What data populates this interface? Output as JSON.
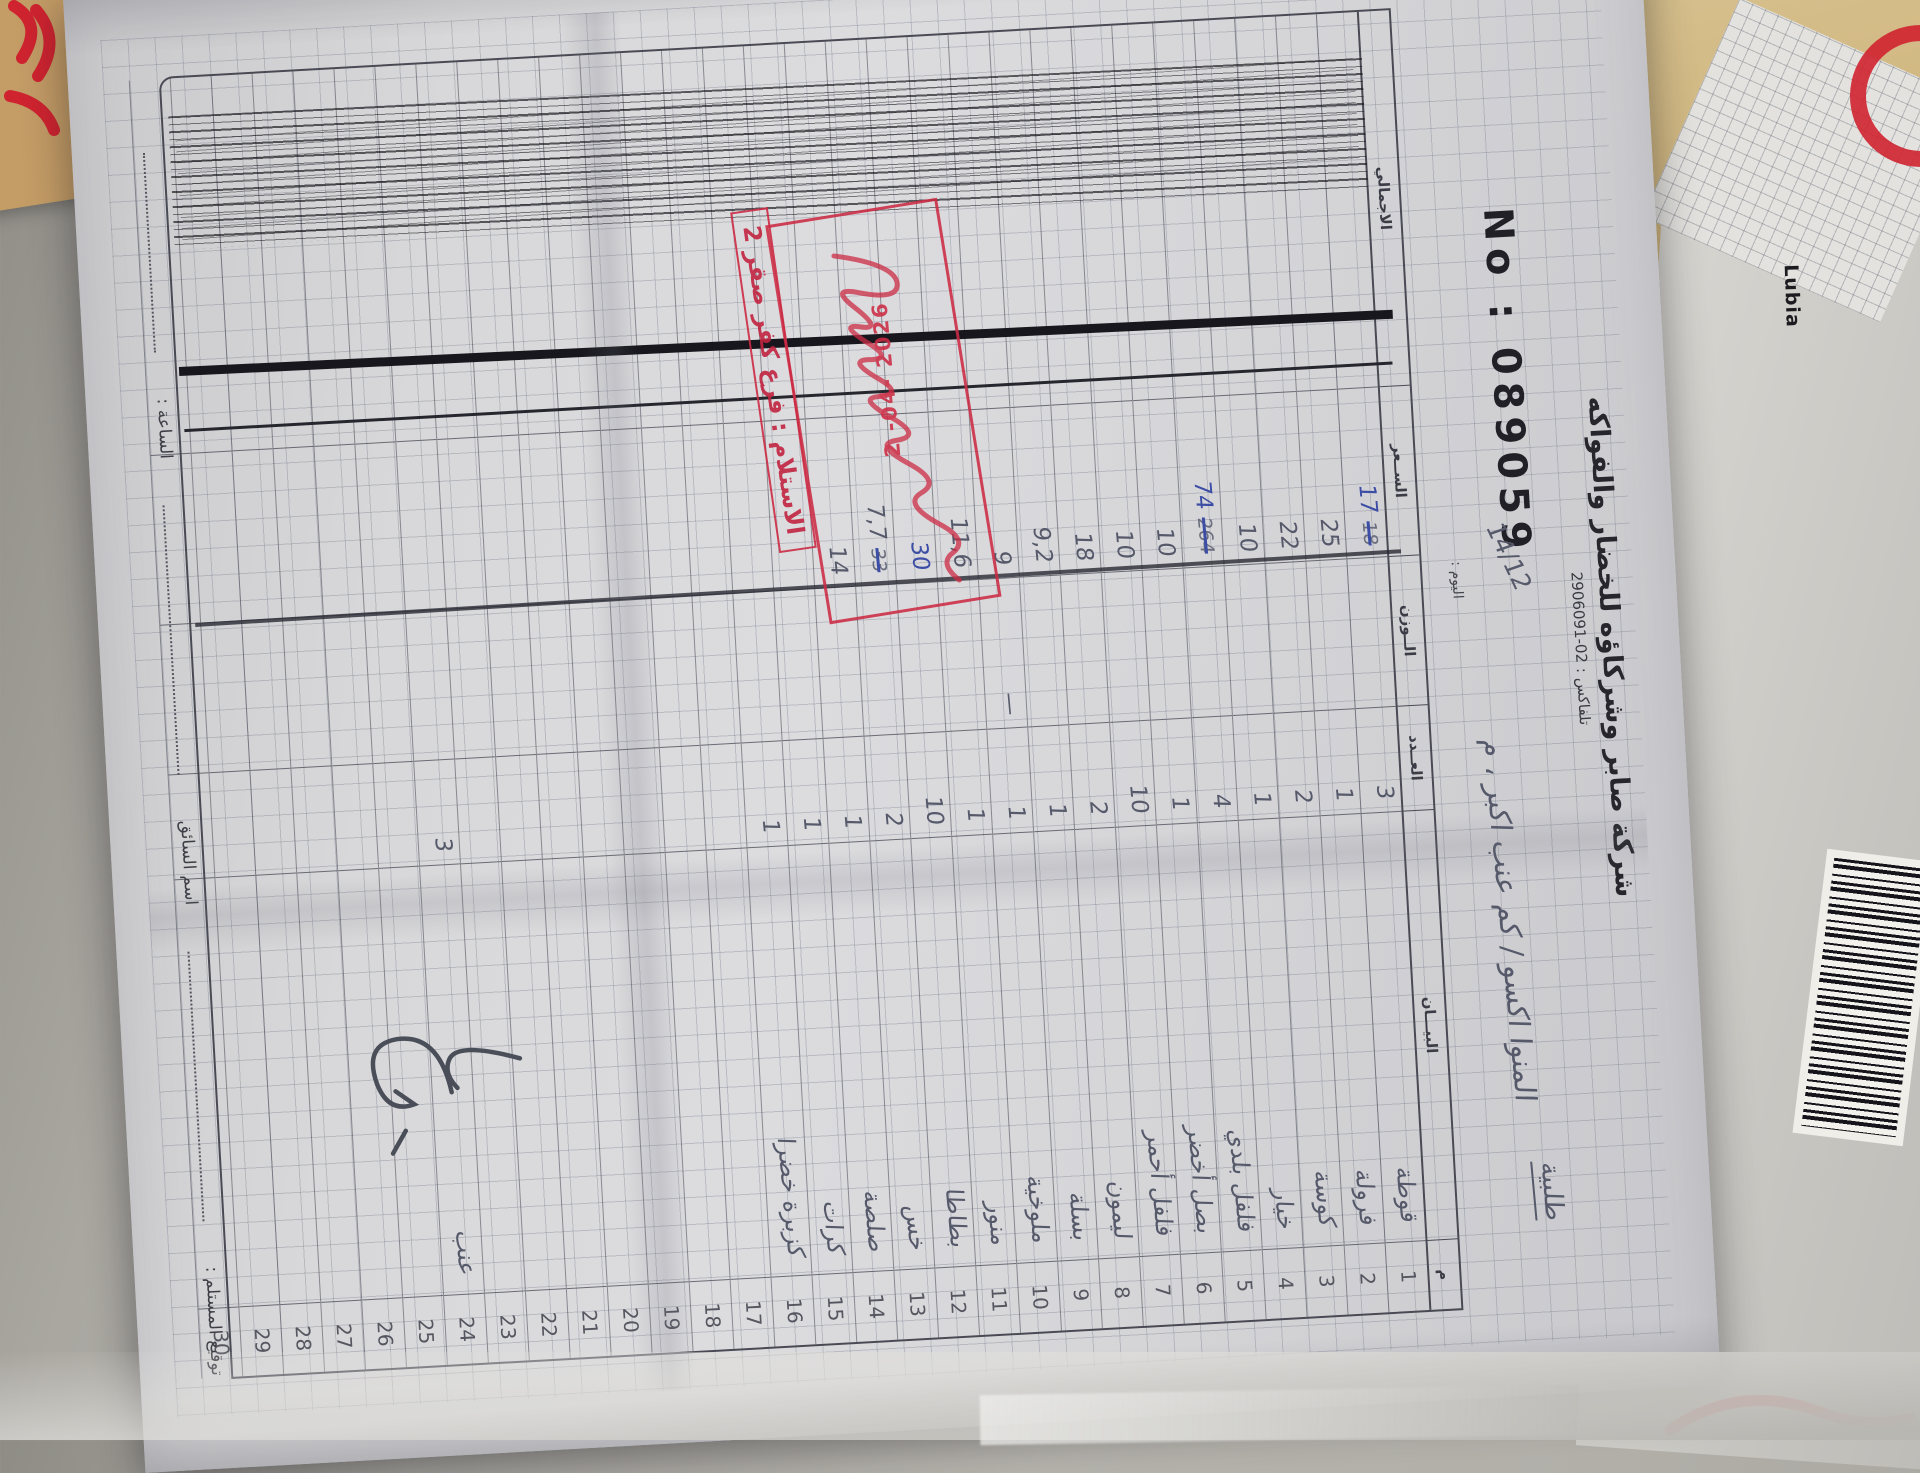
{
  "company": {
    "name": "شركة صابر وشركاؤه للخضار والفواكه",
    "phone": "تلفاكس : 02-2906091",
    "serial": "No : 089059"
  },
  "header_hand": {
    "order_word": "طلبية",
    "date": "14/12",
    "day_label": "اليوم :",
    "customer_line": "المنوا اكسو / كم عنب اكبر ، م"
  },
  "table": {
    "headers": {
      "serial": "م",
      "desc": "البيـــان",
      "qty": "العــدد",
      "weight": "الــوزن",
      "price": "الســعر",
      "total": "الاجمالي"
    },
    "rows": [
      {
        "n": "1",
        "desc": "قوطة",
        "qty": "3",
        "wt": "",
        "price": "17",
        "price_old": "18",
        "blue": true
      },
      {
        "n": "2",
        "desc": "فرولة",
        "qty": "1",
        "wt": "",
        "price": "25",
        "price_old": "",
        "blue": false
      },
      {
        "n": "3",
        "desc": "كوسة",
        "qty": "2",
        "wt": "",
        "price": "22",
        "price_old": "",
        "blue": false
      },
      {
        "n": "4",
        "desc": "خيار",
        "qty": "1",
        "wt": "",
        "price": "10",
        "price_old": "",
        "blue": false
      },
      {
        "n": "5",
        "desc": "فلفل بلدي",
        "qty": "4",
        "wt": "",
        "price": "74",
        "price_old": "264",
        "blue": true
      },
      {
        "n": "6",
        "desc": "بصل أخضر",
        "qty": "1",
        "wt": "",
        "price": "10",
        "price_old": "",
        "blue": false
      },
      {
        "n": "7",
        "desc": "فلفل أحمر",
        "qty": "10",
        "wt": "",
        "price": "10",
        "price_old": "",
        "blue": false
      },
      {
        "n": "8",
        "desc": "ليمون",
        "qty": "2",
        "wt": "",
        "price": "18",
        "price_old": "",
        "blue": false
      },
      {
        "n": "9",
        "desc": "بسلة",
        "qty": "1",
        "wt": "",
        "price": "9,2",
        "price_old": "",
        "blue": false
      },
      {
        "n": "10",
        "desc": "ملوخية",
        "qty": "1",
        "wt": "—",
        "price": "9",
        "price_old": "",
        "blue": false
      },
      {
        "n": "11",
        "desc": "منور",
        "qty": "1",
        "wt": "",
        "price": "11,6",
        "price_old": "",
        "blue": false
      },
      {
        "n": "12",
        "desc": "بطاطا",
        "qty": "10",
        "wt": "",
        "price": "30",
        "price_old": "",
        "blue": true
      },
      {
        "n": "13",
        "desc": "خس",
        "qty": "2",
        "wt": "",
        "price": "7,7",
        "price_old": "33",
        "blue": false
      },
      {
        "n": "14",
        "desc": "صلصة",
        "qty": "1",
        "wt": "",
        "price": "14",
        "price_old": "",
        "blue": false
      },
      {
        "n": "15",
        "desc": "كرات",
        "qty": "1",
        "wt": "",
        "price": "",
        "price_old": "",
        "blue": false
      },
      {
        "n": "16",
        "desc": "كزبرة خضرا",
        "qty": "1",
        "wt": "",
        "price": "",
        "price_old": "",
        "blue": false
      },
      {
        "n": "17",
        "desc": "",
        "qty": "",
        "wt": "",
        "price": "",
        "price_old": "",
        "blue": false
      },
      {
        "n": "18",
        "desc": "",
        "qty": "",
        "wt": "",
        "price": "",
        "price_old": "",
        "blue": false
      },
      {
        "n": "19",
        "desc": "",
        "qty": "",
        "wt": "",
        "price": "",
        "price_old": "",
        "blue": false
      },
      {
        "n": "20",
        "desc": "",
        "qty": "",
        "wt": "",
        "price": "",
        "price_old": "",
        "blue": false
      },
      {
        "n": "21",
        "desc": "",
        "qty": "",
        "wt": "",
        "price": "",
        "price_old": "",
        "blue": false
      },
      {
        "n": "22",
        "desc": "",
        "qty": "",
        "wt": "",
        "price": "",
        "price_old": "",
        "blue": false
      },
      {
        "n": "23",
        "desc": "",
        "qty": "",
        "wt": "",
        "price": "",
        "price_old": "",
        "blue": false
      },
      {
        "n": "24",
        "desc": "عنب",
        "qty": "3",
        "wt": "",
        "price": "",
        "price_old": "",
        "blue": false
      },
      {
        "n": "25",
        "desc": "",
        "qty": "",
        "wt": "",
        "price": "",
        "price_old": "",
        "blue": false
      },
      {
        "n": "26",
        "desc": "",
        "qty": "",
        "wt": "",
        "price": "",
        "price_old": "",
        "blue": false
      },
      {
        "n": "27",
        "desc": "",
        "qty": "",
        "wt": "",
        "price": "",
        "price_old": "",
        "blue": false
      },
      {
        "n": "28",
        "desc": "",
        "qty": "",
        "wt": "",
        "price": "",
        "price_old": "",
        "blue": false
      },
      {
        "n": "29",
        "desc": "",
        "qty": "",
        "wt": "",
        "price": "",
        "price_old": "",
        "blue": false
      },
      {
        "n": "30",
        "desc": "",
        "qty": "",
        "wt": "",
        "price": "",
        "price_old": "",
        "blue": false
      }
    ]
  },
  "stamp": {
    "date": "2 -04- 2026",
    "branch": "الاستلام : فرع كفر صقر 2",
    "color": "#cc2b44"
  },
  "footer": {
    "recipient": "توقيع المستلم :",
    "driver": "اسم السائق",
    "time": "الساعة :"
  },
  "background": {
    "scrap_label": "Lubia"
  }
}
